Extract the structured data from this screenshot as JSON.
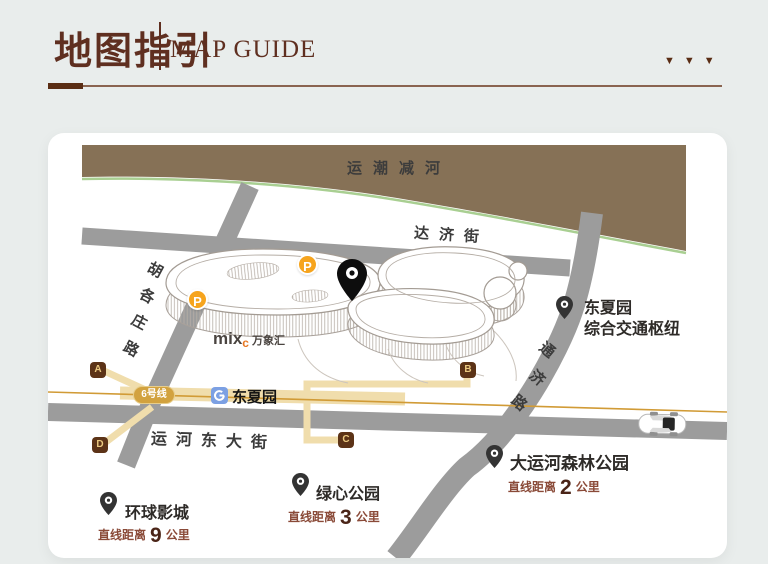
{
  "header": {
    "title_zh": "地图指引",
    "title_en": "MAP GUIDE",
    "deco_triangles": "▼▼▼"
  },
  "map": {
    "river": {
      "label": "运潮减河"
    },
    "streets": {
      "daji": "达济街",
      "yunhe": "运河东大街",
      "hugezhuang_chars": [
        "胡",
        "各",
        "庄",
        "路"
      ],
      "tongji_chars": [
        "通",
        "济",
        "路"
      ]
    },
    "metro": {
      "line_label": "6号线",
      "station_label": "东夏园",
      "exits": [
        "A",
        "B",
        "C",
        "D"
      ]
    },
    "parking_label": "P",
    "building": {
      "logo_mix": "mix",
      "logo_c": "c",
      "logo_name": "万象汇"
    },
    "pois": {
      "hub": {
        "name": "东夏园",
        "name2": "综合交通枢纽"
      },
      "forest_park": {
        "name": "大运河森林公园",
        "distance_prefix": "直线距离",
        "distance_value": "2",
        "distance_unit": "公里"
      },
      "green_park": {
        "name": "绿心公园",
        "distance_prefix": "直线距离",
        "distance_value": "3",
        "distance_unit": "公里"
      },
      "universal": {
        "name": "环球影城",
        "distance_prefix": "直线距离",
        "distance_value": "9",
        "distance_unit": "公里"
      }
    }
  },
  "colors": {
    "accent_brown": "#5F2F20",
    "river_brown": "#867156",
    "river_green_edge": "#A9CF92",
    "road_gray": "#9C9C9C",
    "route_tan": "#F0DDAC",
    "line6_gold": "#D2A23F",
    "exit_brown": "#5C3317",
    "parking_orange": "#F6A41D",
    "metro_blue": "#7CA0E3",
    "logo_orange": "#E87722"
  }
}
